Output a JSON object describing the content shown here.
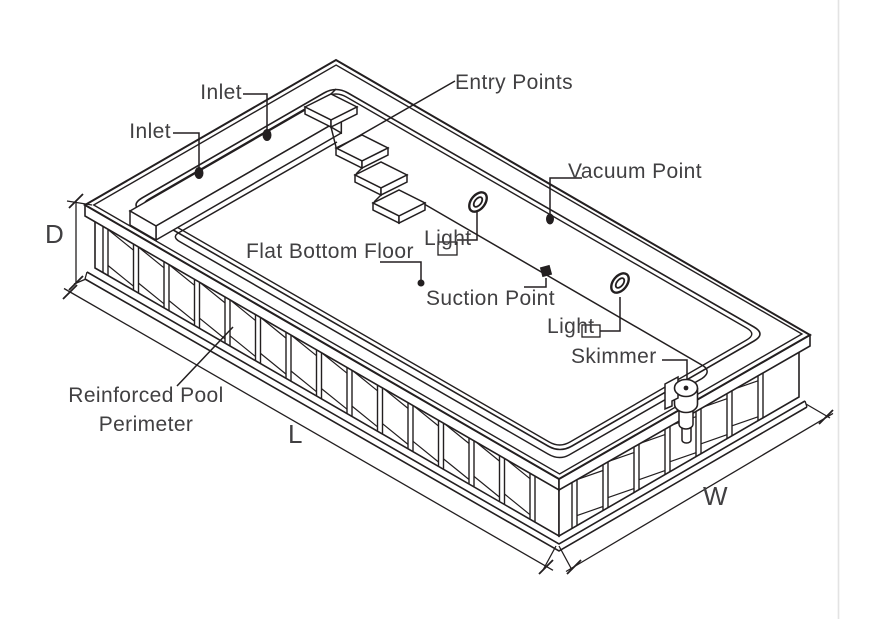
{
  "diagram": {
    "type": "isometric-pool-technical-drawing",
    "labels": {
      "inlet_top": "Inlet",
      "inlet_side": "Inlet",
      "entry_points": "Entry Points",
      "vacuum_point": "Vacuum Point",
      "flat_bottom_floor": "Flat Bottom Floor",
      "light_upper": "Light",
      "light_lower": "Light",
      "suction_point": "Suction Point",
      "skimmer": "Skimmer",
      "reinforced_line1": "Reinforced Pool",
      "reinforced_line2": "Perimeter"
    },
    "dimensions": {
      "depth": "D",
      "length": "L",
      "width": "W"
    },
    "colors": {
      "line": "#231f20",
      "label_text": "#414042",
      "page_edge_line": "#e3e3e3",
      "background": "#ffffff"
    }
  }
}
